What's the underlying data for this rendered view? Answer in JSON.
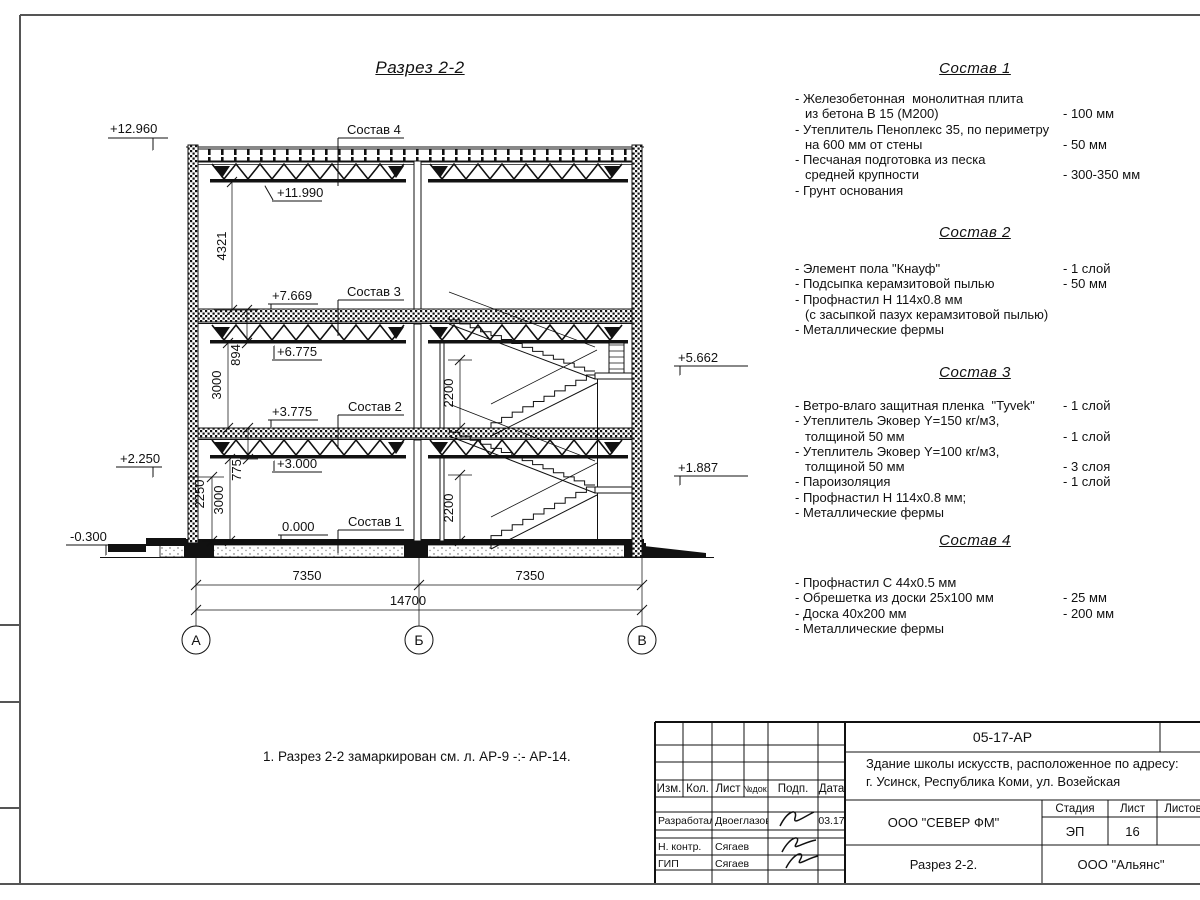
{
  "drawing": {
    "title": "Разрез 2-2",
    "note": "1. Разрез 2-2 замаркирован см. л. АР-9 -:- АР-14.",
    "elev": {
      "a": "+12.960",
      "b": "+11.990",
      "c": "+7.669",
      "d": "+6.775",
      "e": "+3.775",
      "f": "+3.000",
      "g": "0.000",
      "h": "+2.250",
      "i": "-0.300",
      "j": "+5.662",
      "k": "+1.887"
    },
    "dim": {
      "v4321": "4321",
      "v894": "894",
      "v3000a": "3000",
      "v775": "775",
      "v3000b": "3000",
      "v2250": "2250",
      "v2200a": "2200",
      "v2200b": "2200",
      "h7350a": "7350",
      "h7350b": "7350",
      "h14700": "14700"
    },
    "axis": {
      "a": "А",
      "b": "Б",
      "v": "В"
    },
    "leader": {
      "s4": "Состав 4",
      "s3": "Состав 3",
      "s2": "Состав 2",
      "s1": "Состав 1"
    }
  },
  "compositions": [
    {
      "title": "Состав 1",
      "items": [
        {
          "t": "- Железобетонная  монолитная плита",
          "v": ""
        },
        {
          "t": "из бетона В 15 (М200)",
          "v": "- 100 мм"
        },
        {
          "t": "- Утеплитель Пеноплекс 35, по периметру",
          "v": ""
        },
        {
          "t": "на 600 мм от стены",
          "v": "- 50 мм"
        },
        {
          "t": "- Песчаная подготовка из песка",
          "v": ""
        },
        {
          "t": "средней крупности",
          "v": "- 300-350 мм"
        },
        {
          "t": "- Грунт основания",
          "v": ""
        }
      ]
    },
    {
      "title": "Состав 2",
      "items": [
        {
          "t": "- Элемент пола \"Кнауф\"",
          "v": "- 1 слой"
        },
        {
          "t": "- Подсыпка керамзитовой пылью",
          "v": "- 50 мм"
        },
        {
          "t": "- Профнастил Н 114х0.8 мм",
          "v": ""
        },
        {
          "t": "(с засыпкой пазух керамзитовой пылью)",
          "v": ""
        },
        {
          "t": "- Металлические фермы",
          "v": ""
        }
      ]
    },
    {
      "title": "Состав 3",
      "items": [
        {
          "t": "- Ветро-влаго защитная пленка  \"Tyvek\"",
          "v": "- 1 слой"
        },
        {
          "t": "- Утеплитель Эковер Y=150 кг/м3,",
          "v": ""
        },
        {
          "t": "толщиной 50 мм",
          "v": "- 1 слой"
        },
        {
          "t": "- Утеплитель Эковер Y=100 кг/м3,",
          "v": ""
        },
        {
          "t": "толщиной 50 мм",
          "v": "- 3 слоя"
        },
        {
          "t": "- Пароизоляция",
          "v": "- 1 слой"
        },
        {
          "t": "- Профнастил Н 114х0.8 мм;",
          "v": ""
        },
        {
          "t": "- Металлические фермы",
          "v": ""
        }
      ]
    },
    {
      "title": "Состав 4",
      "items": [
        {
          "t": "- Профнастил С 44х0.5 мм",
          "v": ""
        },
        {
          "t": "- Обрешетка из доски 25х100 мм",
          "v": "- 25 мм"
        },
        {
          "t": "- Доска 40х200 мм",
          "v": "- 200 мм"
        },
        {
          "t": "- Металлические фермы",
          "v": ""
        }
      ]
    }
  ],
  "titleblock": {
    "doc_number": "05-17-АР",
    "project_line1": "Здание школы искусств, расположенное по адресу:",
    "project_line2": "г. Усинск, Республика Коми, ул. Возейская",
    "org": "ООО \"СЕВЕР ФМ\"",
    "sheet_title": "Разрез 2-2.",
    "contractor": "ООО \"Альянс\"",
    "stage_label": "Стадия",
    "sheet_label": "Лист",
    "sheets_label": "Листов",
    "stage": "ЭП",
    "sheet_no": "16",
    "cols": {
      "izm": "Изм.",
      "kol": "Кол.",
      "list": "Лист",
      "ndoc": "№док.",
      "podp": "Подп.",
      "data": "Дата"
    },
    "rows": [
      {
        "role": "Разработал",
        "name": "Двоеглазов",
        "date": "03.17"
      },
      {
        "role": "Н. контр.",
        "name": "Сягаев",
        "date": ""
      },
      {
        "role": "ГИП",
        "name": "Сягаев",
        "date": ""
      }
    ]
  }
}
